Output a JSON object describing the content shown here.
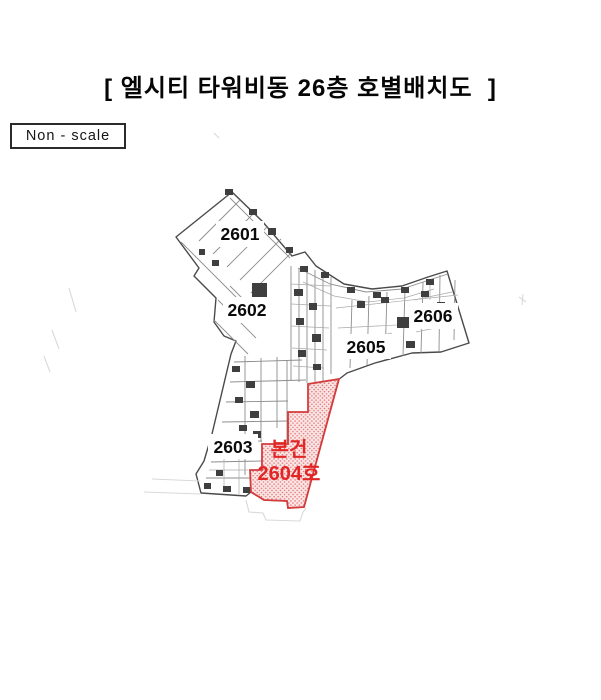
{
  "document": {
    "title": "[ 엘시티 타워비동 26층 호별배치도  ]",
    "scale_note": "Non - scale"
  },
  "floor_plan": {
    "units": [
      {
        "number": "2601"
      },
      {
        "number": "2602"
      },
      {
        "number": "2603"
      },
      {
        "number": "2605"
      },
      {
        "number": "2606"
      }
    ],
    "subject": {
      "tag": "본건",
      "label": "2604호"
    },
    "colors": {
      "highlight_red": "#e12626",
      "highlight_border": "#d43c3c",
      "hatch_dot": "#e06060",
      "hatch_bg": "#f9e2e2"
    }
  }
}
